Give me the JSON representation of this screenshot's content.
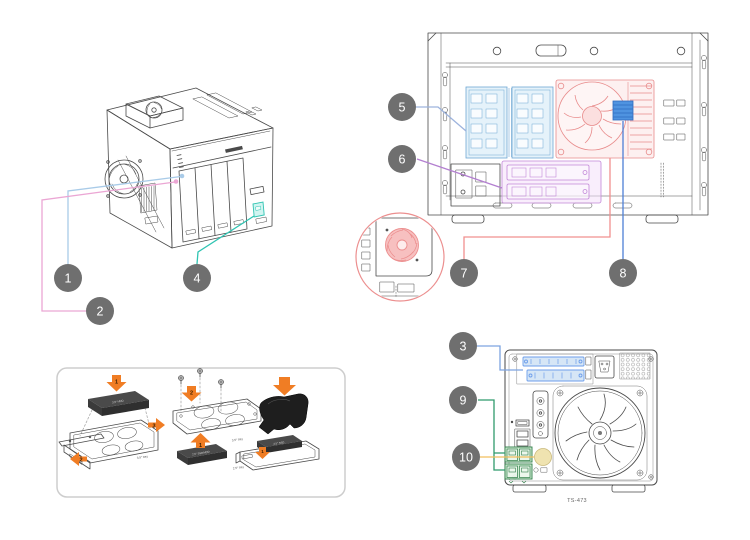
{
  "figure": {
    "model_label": "TS-473",
    "background": "#ffffff"
  },
  "callout_style": {
    "bg": "#6f6f6f",
    "text_color": "#ffffff"
  },
  "callouts": [
    {
      "label": "1",
      "color": "#a9cbe8"
    },
    {
      "label": "2",
      "color": "#eba6d4"
    },
    {
      "label": "3",
      "color": "#7da3e0"
    },
    {
      "label": "4",
      "color": "#2fc4b2"
    },
    {
      "label": "5",
      "color": "#9db3dd"
    },
    {
      "label": "6",
      "color": "#b37fd0"
    },
    {
      "label": "7",
      "color": "#f0908f"
    },
    {
      "label": "8",
      "color": "#4d7fd6"
    },
    {
      "label": "9",
      "color": "#2f9a6c"
    },
    {
      "label": "10",
      "color": "#f2bf5e"
    }
  ],
  "highlights": {
    "ram": {
      "fill": "#cfe7f5",
      "stroke": "#6fa7d4"
    },
    "heatsink": {
      "fill": "#fbdddd",
      "stroke": "#e88b8b"
    },
    "thermal_pad": {
      "fill": "#4f93e0",
      "stroke": "#2f6bbf"
    },
    "m2": {
      "fill": "#f3def9",
      "stroke": "#c287d8"
    },
    "detail_fan": {
      "fill": "#f7c0c0",
      "stroke": "#ec8f8f"
    },
    "pcie": {
      "fill": "#cfe2f5",
      "stroke": "#6d9eeb"
    },
    "lan": {
      "fill": "#cdeacf",
      "stroke": "#2d7d46"
    },
    "speaker": {
      "fill": "#efe3b0",
      "stroke": "#c9b97a"
    },
    "front_usb": {
      "fill": "#c9f3ee",
      "stroke": "#2fc4b2"
    }
  },
  "tray_guide": {
    "arrow_color": "#f07d24",
    "number_color": "#3d1f00",
    "drive_color": "#4a4a4a",
    "clamp_color": "#1e1e1e",
    "steps": [
      {
        "labels": [
          "3.5\" HDD",
          "3.5\" tray"
        ],
        "arrows": [
          "1",
          "2",
          "3"
        ]
      },
      {
        "labels": [
          "2.5\" SSD/HDD",
          "3.5\" tray"
        ],
        "arrows": [
          "1",
          "2"
        ]
      },
      {
        "labels": [
          "2.5\" SSD",
          "2.5\" tray"
        ],
        "arrows": [
          "1"
        ]
      }
    ]
  }
}
